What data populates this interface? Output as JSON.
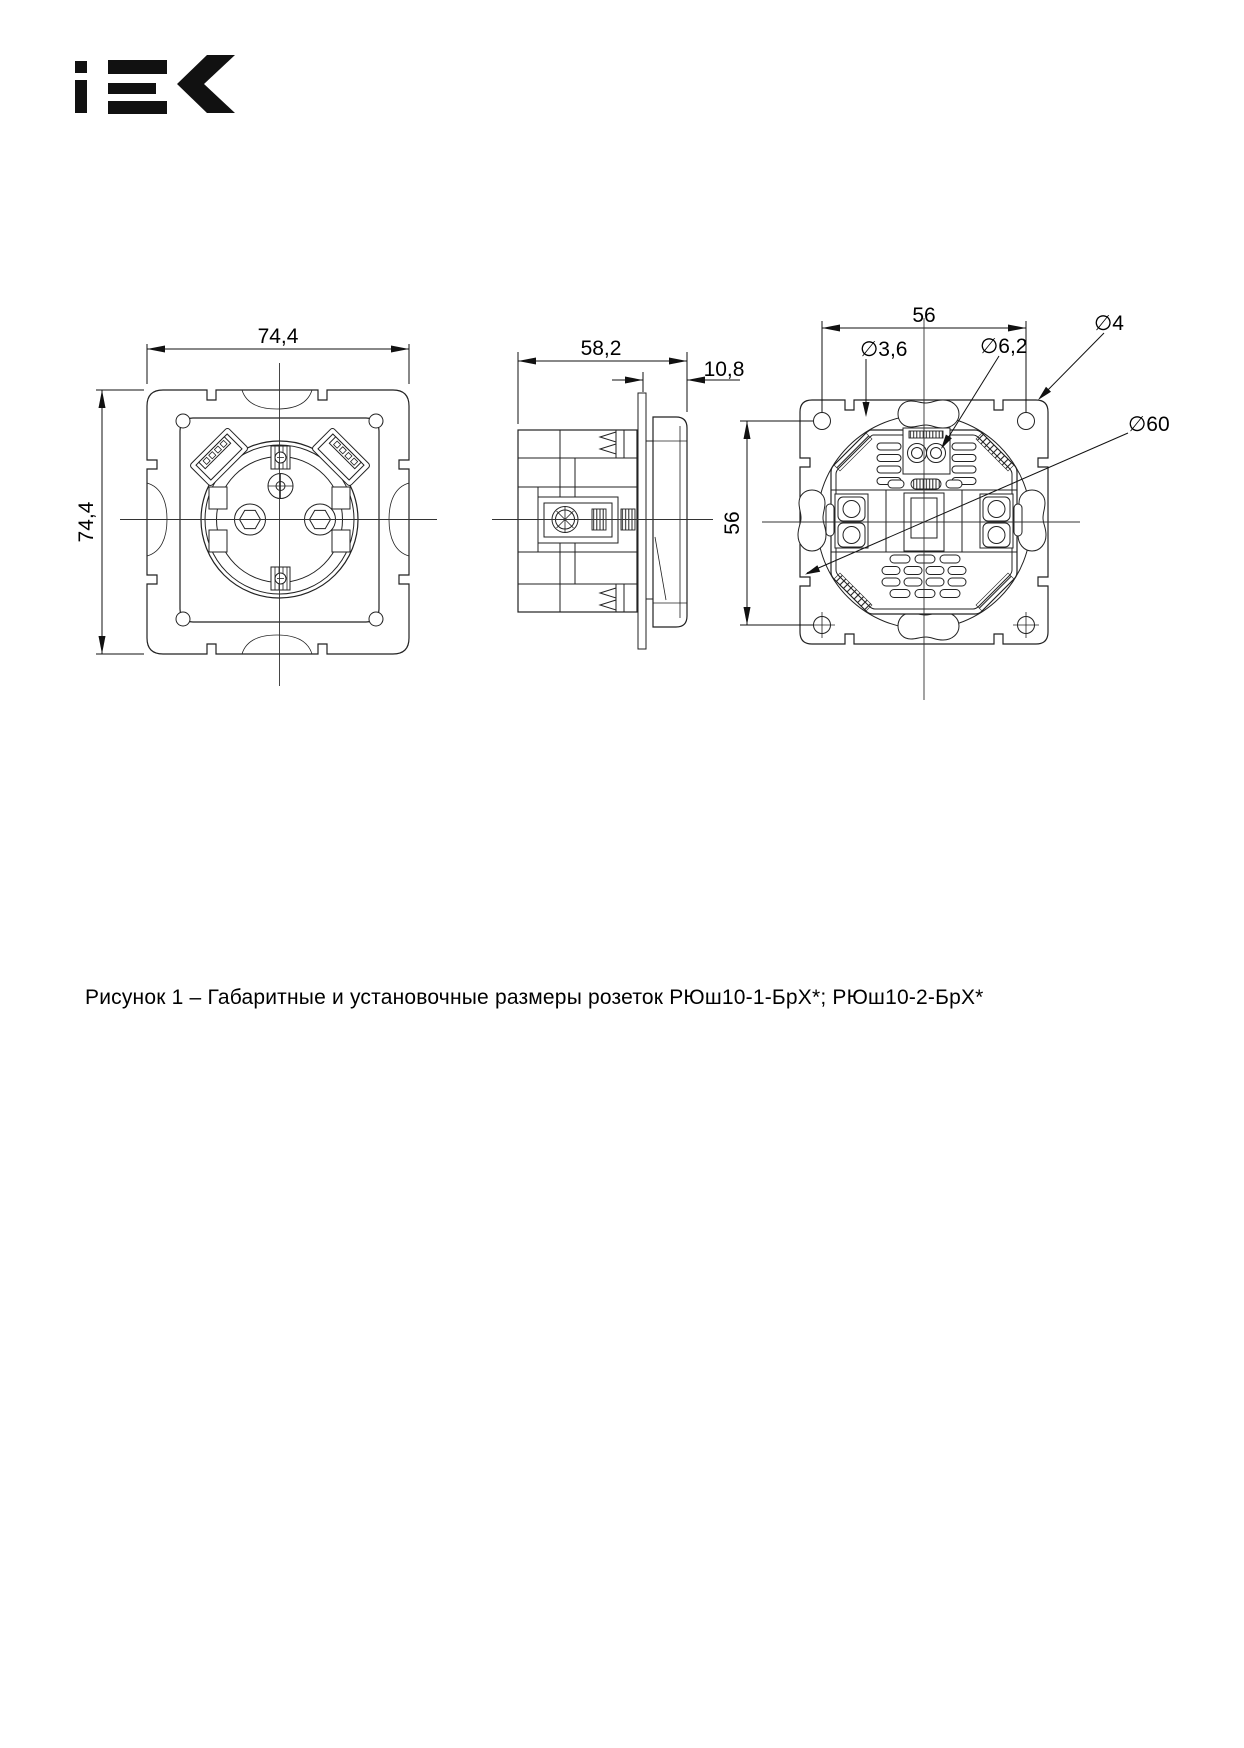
{
  "brand": "IEK",
  "figure": {
    "caption": "Рисунок 1 – Габаритные и установочные размеры розеток РЮш10-1-БрХ*; РЮш10-2-БрХ*"
  },
  "drawing": {
    "front_view": {
      "width": "74,4",
      "height": "74,4"
    },
    "side_view": {
      "depth": "58,2",
      "front_thickness": "10,8"
    },
    "back_view": {
      "hole_spacing_horizontal": "56",
      "hole_spacing_vertical": "56",
      "dia_small_hole": "∅3,6",
      "dia_large_hole": "∅6,2",
      "dia_corner_hole": "∅4",
      "dia_body": "∅60"
    }
  }
}
